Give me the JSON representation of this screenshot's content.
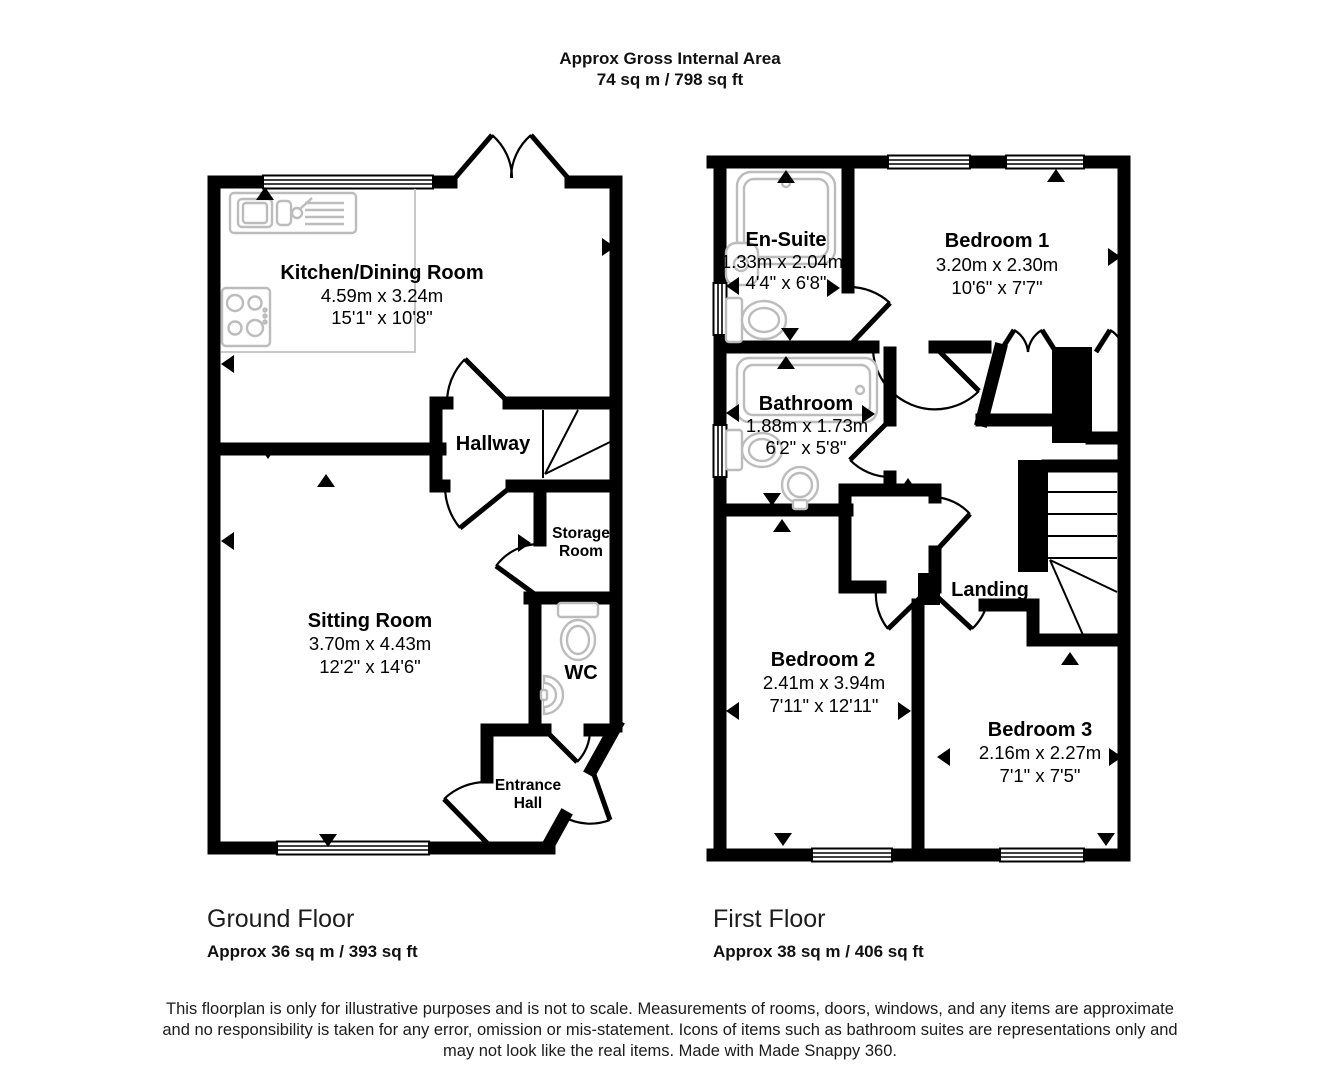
{
  "header": {
    "title": "Approx Gross Internal Area",
    "subtitle": "74 sq m / 798 sq ft"
  },
  "floors": [
    {
      "title": "Ground Floor",
      "area": "Approx 36 sq m / 393 sq ft",
      "rooms": {
        "kitchen": {
          "name": "Kitchen/Dining Room",
          "metric": "4.59m x 3.24m",
          "imperial": "15'1\" x 10'8\""
        },
        "hallway": {
          "name": "Hallway"
        },
        "storage": {
          "line1": "Storage",
          "line2": "Room"
        },
        "sitting": {
          "name": "Sitting Room",
          "metric": "3.70m x 4.43m",
          "imperial": "12'2\" x 14'6\""
        },
        "wc": {
          "name": "WC"
        },
        "entrance": {
          "line1": "Entrance",
          "line2": "Hall"
        }
      }
    },
    {
      "title": "First Floor",
      "area": "Approx 38 sq m / 406 sq ft",
      "rooms": {
        "ensuite": {
          "name": "En-Suite",
          "metric": "1.33m x 2.04m",
          "imperial": "4'4\" x 6'8\""
        },
        "bedroom1": {
          "name": "Bedroom 1",
          "metric": "3.20m x 2.30m",
          "imperial": "10'6\" x 7'7\""
        },
        "bathroom": {
          "name": "Bathroom",
          "metric": "1.88m x 1.73m",
          "imperial": "6'2\" x 5'8\""
        },
        "landing": {
          "name": "Landing"
        },
        "bedroom2": {
          "name": "Bedroom 2",
          "metric": "2.41m x 3.94m",
          "imperial": "7'11\" x 12'11\""
        },
        "bedroom3": {
          "name": "Bedroom 3",
          "metric": "2.16m x 2.27m",
          "imperial": "7'1\" x 7'5\""
        }
      }
    }
  ],
  "footer": {
    "disclaimer_lines": [
      "This floorplan is only for illustrative purposes and is not to scale. Measurements of rooms, doors, windows, and any items are approximate",
      "and no responsibility is taken for any error, omission or mis-statement. Icons of items such as bathroom suites are representations only and",
      "may not look like the real items. Made with Made Snappy 360."
    ]
  },
  "colors": {
    "wall": "#000000",
    "fixture": "#bcbcbc"
  }
}
